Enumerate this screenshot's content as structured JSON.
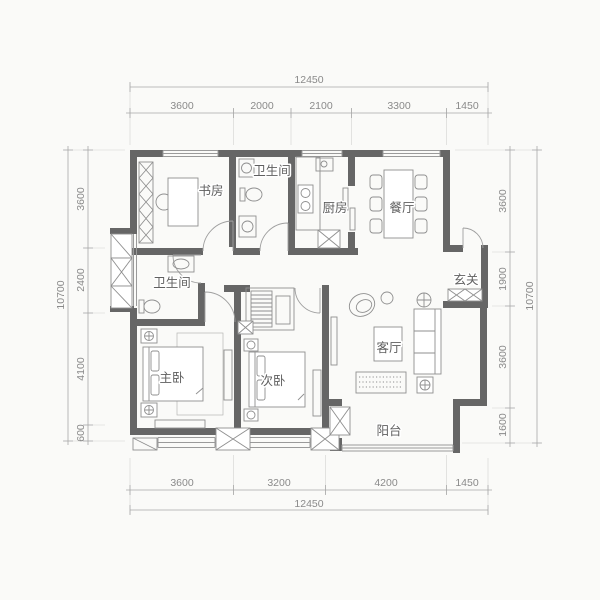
{
  "plan": {
    "rooms": {
      "study": "书房",
      "bath1": "卫生间",
      "kitchen": "厨房",
      "dining": "餐厅",
      "bath2": "卫生间",
      "entry": "玄关",
      "master": "主卧",
      "second": "次卧",
      "living": "客厅",
      "balcony": "阳台"
    },
    "dims": {
      "top": {
        "total": "12450",
        "segments": [
          "3600",
          "2000",
          "2100",
          "3300",
          "1450"
        ]
      },
      "bottom": {
        "total": "12450",
        "segments": [
          "3600",
          "3200",
          "4200",
          "1450"
        ]
      },
      "left": {
        "total": "10700",
        "segments": [
          "3600",
          "2400",
          "4100",
          "600"
        ]
      },
      "right": {
        "total": "10700",
        "segments": [
          "3600",
          "1900",
          "3600",
          "1600"
        ]
      }
    },
    "colors": {
      "wall": "#666666",
      "furniture_line": "#8f8f8f",
      "dimension_text": "#8a8a8a",
      "room_label_text": "#5f5f5f",
      "background": "#fafaf8"
    }
  }
}
